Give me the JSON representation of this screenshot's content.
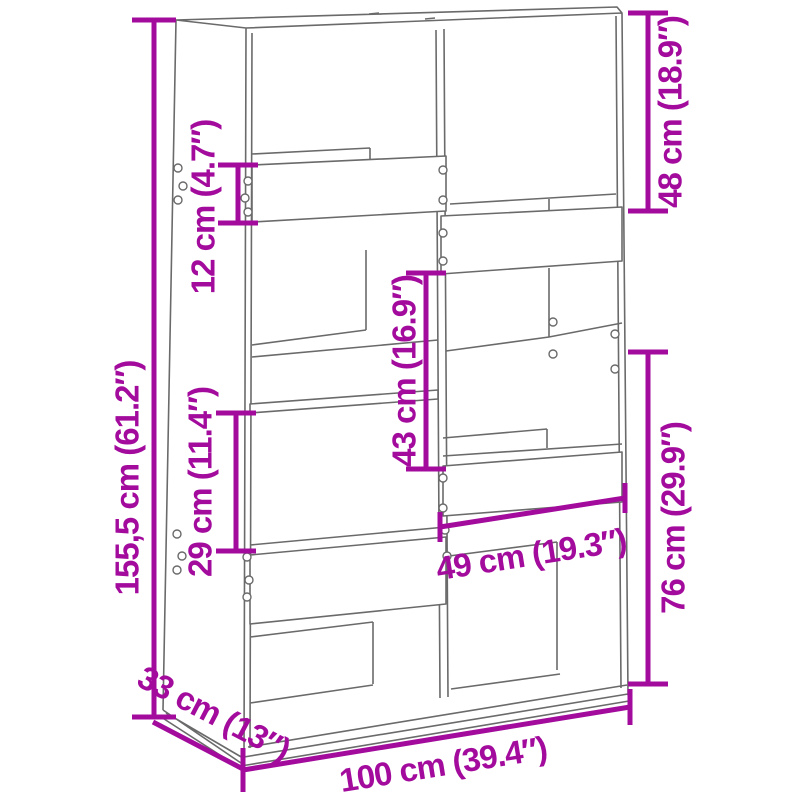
{
  "page": {
    "type": "product dimension diagram",
    "product": "bookcase room divider line drawing",
    "background": "#ffffff"
  },
  "colors": {
    "dimension_annotation": "#A30B9D",
    "drawing_lines": "#6a6a6a"
  },
  "dimensions": {
    "height": {
      "label": "155,5 cm (61.2″)"
    },
    "top_opening": {
      "label": "48 cm (18.9″)"
    },
    "shelf_front": {
      "label": "12 cm (4.7″)"
    },
    "middle_opening": {
      "label": "43 cm (16.9″)"
    },
    "left_opening": {
      "label": "29 cm (11.4″)"
    },
    "lower_right": {
      "label": "76 cm (29.9″)"
    },
    "inner_width": {
      "label": "49 cm (19.3″)"
    },
    "width": {
      "label": "100 cm (39.4″)"
    },
    "depth": {
      "label": "33 cm (13″)"
    }
  }
}
